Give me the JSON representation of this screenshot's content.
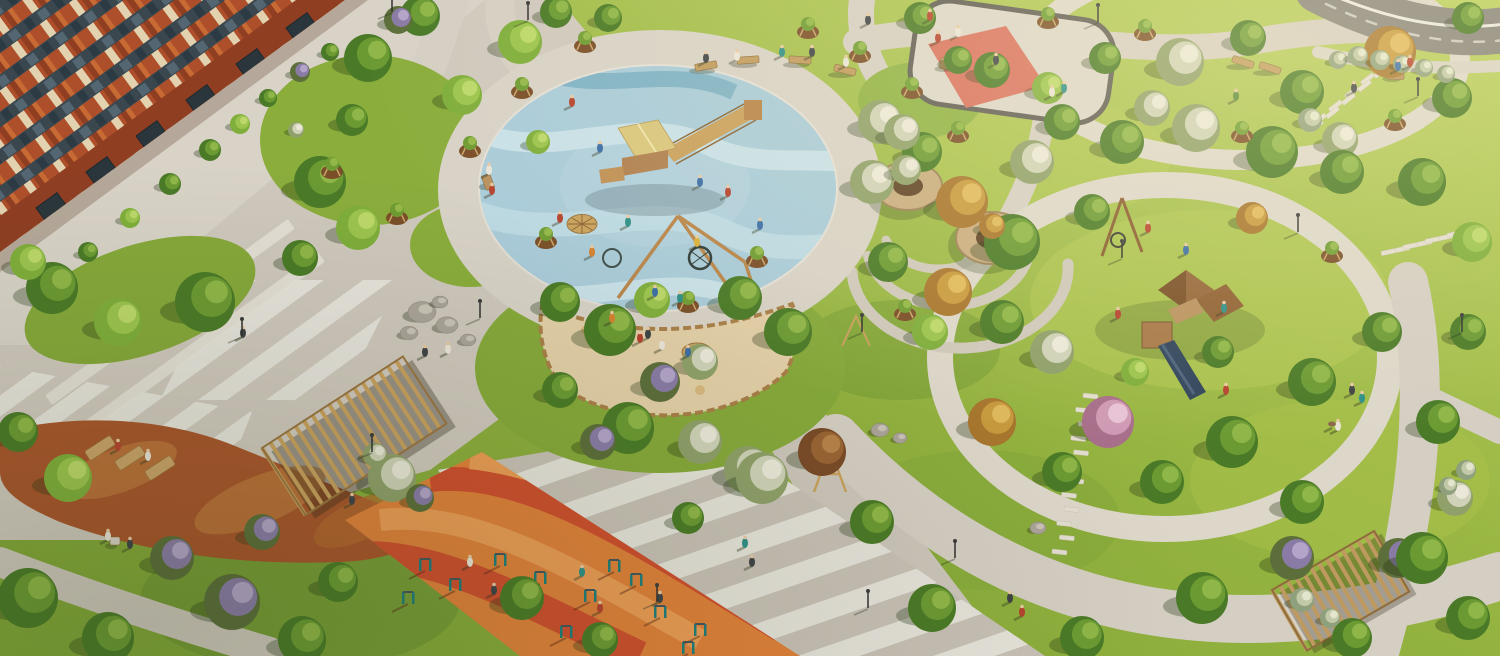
{
  "meta": {
    "description": "aerial 3D rendering of residential courtyard park with playgrounds, paths and trees",
    "width": 1500,
    "height": 656
  },
  "palette": {
    "grass_light": "#bcd05e",
    "grass_mid": "#93b23f",
    "grass_dark": "#7fa437",
    "paving": "#d2cbc0",
    "paving_light": "#e9e6de",
    "paving_shade": "#b9b2a7",
    "asphalt": "#87837c",
    "brick_orange": "#b4532c",
    "brick_dark": "#8f3e22",
    "cream_panel": "#e3d2b0",
    "window_glass": "#3a474f",
    "rubber_blue": "#a9cbd9",
    "rubber_blue_light": "#c8e0e8",
    "rubber_blue_deep": "#7fb2c6",
    "sand": "#e3cfa8",
    "log_border": "#a97e48",
    "sport_orange": "#e0813a",
    "sport_red": "#cf4e2e",
    "sport_salmon": "#ec9c55",
    "mulch_rust": "#a8552b",
    "mulch_light": "#c07a3e",
    "wood": "#b8925e",
    "wood_dark": "#8a6434",
    "wood_roof": "#8a5c30",
    "slide_navy": "#31455c",
    "equipment_teal": "#1f7d7a",
    "plaza_red": "#d9705f",
    "stone": "#e3ddcf"
  },
  "tree_colors": {
    "g": [
      "#4a7a27",
      "#6b9a33",
      "#8fb648"
    ],
    "gl": [
      "#7fae3b",
      "#9cc44e",
      "#bcd86a"
    ],
    "bw": [
      "#8fa06a",
      "#cfd2b8",
      "#ebe8d9"
    ],
    "bp": [
      "#a86f8a",
      "#cf9ab4",
      "#e7c3d6"
    ],
    "gold": [
      "#a8762e",
      "#c89a3e",
      "#e0b95c"
    ],
    "ar": [
      "#7a4a28",
      "#9a6434",
      "#b8824a"
    ],
    "lilac": [
      "#5c6e3a",
      "#8a7ba6",
      "#b3a4c9"
    ],
    "silver": [
      "#8fa07c",
      "#c2c9a8",
      "#e3e6cd"
    ]
  },
  "people_colors": {
    "red": "#b5422e",
    "blue": "#3c6da5",
    "teal": "#2e8f86",
    "orange": "#d4802f",
    "white": "#e9e4d8",
    "dark": "#3f4346",
    "yellow": "#d9b13b",
    "green": "#5a8a3c",
    "pink": "#c77a8a",
    "dog": "#8a6a4a"
  },
  "scene": {
    "areas": [
      "apartment-building",
      "central-splash-playground",
      "sandbox",
      "workout-ground",
      "table-tennis-plaza",
      "lawn-playground",
      "loop-paths",
      "pergolas",
      "autumn-mulch-garden"
    ]
  },
  "trees": [
    [
      368,
      58,
      24,
      "g"
    ],
    [
      420,
      16,
      20,
      "g"
    ],
    [
      462,
      95,
      20,
      "gl"
    ],
    [
      352,
      120,
      16,
      "g"
    ],
    [
      320,
      182,
      26,
      "g"
    ],
    [
      358,
      228,
      22,
      "gl"
    ],
    [
      300,
      258,
      18,
      "g"
    ],
    [
      52,
      288,
      26,
      "g"
    ],
    [
      118,
      322,
      24,
      "gl"
    ],
    [
      205,
      302,
      30,
      "g"
    ],
    [
      28,
      262,
      18,
      "gl"
    ],
    [
      520,
      42,
      22,
      "gl"
    ],
    [
      556,
      12,
      16,
      "g"
    ],
    [
      608,
      18,
      14,
      "g"
    ],
    [
      880,
      122,
      22,
      "bw"
    ],
    [
      920,
      18,
      16,
      "g"
    ],
    [
      560,
      302,
      20,
      "g"
    ],
    [
      610,
      330,
      26,
      "g"
    ],
    [
      652,
      300,
      18,
      "gl"
    ],
    [
      740,
      298,
      22,
      "g"
    ],
    [
      788,
      332,
      24,
      "g"
    ],
    [
      628,
      428,
      26,
      "g"
    ],
    [
      560,
      390,
      18,
      "g"
    ],
    [
      700,
      442,
      22,
      "bw"
    ],
    [
      748,
      470,
      24,
      "bw"
    ],
    [
      660,
      382,
      20,
      "lilac"
    ],
    [
      700,
      362,
      18,
      "bw"
    ],
    [
      872,
      182,
      22,
      "bw"
    ],
    [
      922,
      152,
      20,
      "g"
    ],
    [
      962,
      202,
      26,
      "gold"
    ],
    [
      1012,
      242,
      28,
      "g"
    ],
    [
      948,
      292,
      24,
      "gold"
    ],
    [
      1002,
      322,
      22,
      "g"
    ],
    [
      888,
      262,
      20,
      "g"
    ],
    [
      930,
      332,
      18,
      "gl"
    ],
    [
      1032,
      162,
      22,
      "bw"
    ],
    [
      1062,
      122,
      18,
      "g"
    ],
    [
      992,
      70,
      18,
      "g"
    ],
    [
      1048,
      88,
      16,
      "gl"
    ],
    [
      902,
      132,
      18,
      "bw"
    ],
    [
      958,
      60,
      14,
      "g"
    ],
    [
      1105,
      58,
      16,
      "g"
    ],
    [
      1180,
      62,
      24,
      "bw"
    ],
    [
      1248,
      38,
      18,
      "g"
    ],
    [
      1302,
      92,
      22,
      "g"
    ],
    [
      1390,
      52,
      26,
      "gold"
    ],
    [
      1452,
      98,
      20,
      "g"
    ],
    [
      1468,
      18,
      16,
      "g"
    ],
    [
      1340,
      140,
      18,
      "bw"
    ],
    [
      1122,
      142,
      22,
      "g"
    ],
    [
      1196,
      128,
      24,
      "bw"
    ],
    [
      1152,
      108,
      18,
      "bw"
    ],
    [
      1272,
      152,
      26,
      "g"
    ],
    [
      1342,
      172,
      22,
      "g"
    ],
    [
      1422,
      182,
      24,
      "g"
    ],
    [
      1472,
      242,
      20,
      "gl"
    ],
    [
      1092,
      212,
      18,
      "g"
    ],
    [
      1252,
      218,
      16,
      "gold"
    ],
    [
      1108,
      422,
      26,
      "bp"
    ],
    [
      1052,
      352,
      22,
      "bw"
    ],
    [
      992,
      422,
      24,
      "gold"
    ],
    [
      1062,
      472,
      20,
      "g"
    ],
    [
      1162,
      482,
      22,
      "g"
    ],
    [
      1232,
      442,
      26,
      "g"
    ],
    [
      1312,
      382,
      24,
      "g"
    ],
    [
      1382,
      332,
      20,
      "g"
    ],
    [
      1302,
      502,
      22,
      "g"
    ],
    [
      1398,
      558,
      20,
      "lilac"
    ],
    [
      1438,
      422,
      22,
      "g"
    ],
    [
      1468,
      332,
      18,
      "g"
    ],
    [
      1218,
      352,
      16,
      "g"
    ],
    [
      1135,
      372,
      14,
      "gl"
    ],
    [
      28,
      598,
      30,
      "g"
    ],
    [
      108,
      638,
      26,
      "g"
    ],
    [
      232,
      602,
      28,
      "lilac"
    ],
    [
      302,
      640,
      24,
      "g"
    ],
    [
      172,
      558,
      22,
      "lilac"
    ],
    [
      68,
      478,
      24,
      "gl"
    ],
    [
      18,
      432,
      20,
      "g"
    ],
    [
      262,
      532,
      18,
      "lilac"
    ],
    [
      338,
      582,
      20,
      "g"
    ],
    [
      392,
      478,
      24,
      "bw"
    ],
    [
      522,
      598,
      22,
      "g"
    ],
    [
      600,
      640,
      18,
      "g"
    ],
    [
      762,
      478,
      26,
      "bw"
    ],
    [
      822,
      452,
      24,
      "ar"
    ],
    [
      872,
      522,
      22,
      "g"
    ],
    [
      932,
      608,
      24,
      "g"
    ],
    [
      1082,
      638,
      22,
      "g"
    ],
    [
      598,
      442,
      18,
      "lilac"
    ],
    [
      688,
      518,
      16,
      "g"
    ],
    [
      1202,
      598,
      26,
      "g"
    ],
    [
      1292,
      558,
      22,
      "lilac"
    ],
    [
      1422,
      558,
      26,
      "g"
    ],
    [
      1468,
      618,
      22,
      "g"
    ],
    [
      1352,
      638,
      20,
      "g"
    ],
    [
      1455,
      498,
      18,
      "bw"
    ],
    [
      210,
      150,
      11,
      "g"
    ],
    [
      240,
      124,
      10,
      "gl"
    ],
    [
      170,
      184,
      11,
      "g"
    ],
    [
      130,
      218,
      10,
      "gl"
    ],
    [
      88,
      252,
      10,
      "g"
    ],
    [
      268,
      98,
      9,
      "g"
    ],
    [
      300,
      72,
      10,
      "lilac"
    ],
    [
      330,
      52,
      9,
      "g"
    ],
    [
      296,
      130,
      8,
      "bw"
    ],
    [
      398,
      20,
      14,
      "lilac"
    ],
    [
      1338,
      60,
      9,
      "silver"
    ],
    [
      1358,
      56,
      10,
      "silver"
    ],
    [
      1380,
      60,
      10,
      "silver"
    ],
    [
      1402,
      64,
      9,
      "silver"
    ],
    [
      1424,
      68,
      9,
      "silver"
    ],
    [
      1446,
      74,
      9,
      "silver"
    ],
    [
      1310,
      120,
      12,
      "silver"
    ],
    [
      1466,
      470,
      10,
      "silver"
    ],
    [
      1448,
      486,
      9,
      "silver"
    ],
    [
      1302,
      600,
      12,
      "silver"
    ],
    [
      1330,
      618,
      10,
      "silver"
    ],
    [
      906,
      170,
      15,
      "bw"
    ],
    [
      992,
      226,
      13,
      "gold"
    ],
    [
      420,
      498,
      14,
      "lilac"
    ],
    [
      375,
      455,
      12,
      "bw"
    ],
    [
      538,
      142,
      12,
      "gl"
    ]
  ],
  "saplings": [
    [
      585,
      42
    ],
    [
      522,
      88
    ],
    [
      470,
      147
    ],
    [
      332,
      168
    ],
    [
      397,
      214
    ],
    [
      546,
      238
    ],
    [
      860,
      52
    ],
    [
      912,
      88
    ],
    [
      958,
      132
    ],
    [
      1145,
      30
    ],
    [
      1242,
      132
    ],
    [
      1332,
      252
    ],
    [
      688,
      302
    ],
    [
      757,
      257
    ],
    [
      808,
      28
    ],
    [
      1048,
      18
    ],
    [
      1395,
      120
    ],
    [
      905,
      310
    ]
  ],
  "people": [
    [
      572,
      102,
      "red"
    ],
    [
      600,
      148,
      "blue"
    ],
    [
      628,
      222,
      "teal"
    ],
    [
      560,
      218,
      "red"
    ],
    [
      592,
      252,
      "orange"
    ],
    [
      655,
      292,
      "blue"
    ],
    [
      680,
      298,
      "teal"
    ],
    [
      700,
      182,
      "blue"
    ],
    [
      728,
      192,
      "red"
    ],
    [
      612,
      318,
      "orange"
    ],
    [
      648,
      334,
      "dark"
    ],
    [
      760,
      225,
      "blue"
    ],
    [
      697,
      242,
      "yellow"
    ],
    [
      706,
      58,
      "dark"
    ],
    [
      737,
      56,
      "white"
    ],
    [
      782,
      52,
      "teal"
    ],
    [
      812,
      52,
      "dark"
    ],
    [
      846,
      62,
      "white"
    ],
    [
      489,
      170,
      "white"
    ],
    [
      492,
      190,
      "red"
    ],
    [
      243,
      333,
      "dark"
    ],
    [
      425,
      352,
      "dark"
    ],
    [
      448,
      349,
      "white"
    ],
    [
      640,
      338,
      "red"
    ],
    [
      662,
      345,
      "white"
    ],
    [
      688,
      352,
      "blue"
    ],
    [
      745,
      543,
      "teal"
    ],
    [
      752,
      562,
      "dark"
    ],
    [
      660,
      598,
      "dark"
    ],
    [
      1010,
      598,
      "dark"
    ],
    [
      1022,
      612,
      "red"
    ],
    [
      1052,
      92,
      "white"
    ],
    [
      1064,
      88,
      "teal"
    ],
    [
      938,
      38,
      "red"
    ],
    [
      958,
      32,
      "white"
    ],
    [
      996,
      60,
      "dark"
    ],
    [
      1352,
      390,
      "dark"
    ],
    [
      1362,
      398,
      "teal"
    ],
    [
      1338,
      426,
      "white"
    ],
    [
      1332,
      424,
      "dog"
    ],
    [
      1148,
      228,
      "red"
    ],
    [
      1186,
      250,
      "blue"
    ],
    [
      1224,
      308,
      "teal"
    ],
    [
      1118,
      314,
      "red"
    ],
    [
      1226,
      390,
      "red"
    ],
    [
      1236,
      96,
      "green"
    ],
    [
      118,
      446,
      "red"
    ],
    [
      148,
      456,
      "white"
    ],
    [
      108,
      536,
      "white"
    ],
    [
      130,
      544,
      "dark"
    ],
    [
      1398,
      66,
      "blue"
    ],
    [
      1410,
      62,
      "red"
    ],
    [
      1354,
      88,
      "dark"
    ],
    [
      470,
      562,
      "white"
    ],
    [
      494,
      590,
      "dark"
    ],
    [
      600,
      608,
      "red"
    ],
    [
      582,
      572,
      "teal"
    ],
    [
      930,
      16,
      "red"
    ],
    [
      868,
      20,
      "dark"
    ],
    [
      352,
      500,
      "dark"
    ]
  ],
  "lamps": [
    [
      392,
      12
    ],
    [
      480,
      318
    ],
    [
      657,
      602
    ],
    [
      862,
      332
    ],
    [
      955,
      558
    ],
    [
      1122,
      258
    ],
    [
      1418,
      96
    ],
    [
      1298,
      232
    ],
    [
      242,
      336
    ],
    [
      1462,
      332
    ],
    [
      372,
      452
    ],
    [
      528,
      20
    ],
    [
      1098,
      22
    ],
    [
      868,
      608
    ]
  ],
  "equipment": [
    [
      425,
      565
    ],
    [
      455,
      585
    ],
    [
      408,
      598
    ],
    [
      500,
      560
    ],
    [
      540,
      578
    ],
    [
      590,
      596
    ],
    [
      614,
      566
    ],
    [
      660,
      612
    ],
    [
      700,
      630
    ],
    [
      566,
      632
    ],
    [
      636,
      580
    ],
    [
      688,
      648
    ]
  ],
  "rocks": [
    [
      422,
      312,
      14
    ],
    [
      447,
      325,
      11
    ],
    [
      409,
      333,
      9
    ],
    [
      468,
      340,
      8
    ],
    [
      440,
      302,
      8
    ],
    [
      620,
      414,
      7
    ],
    [
      880,
      430,
      9
    ],
    [
      900,
      438,
      7
    ],
    [
      1038,
      528,
      8
    ],
    [
      1452,
      500,
      7
    ]
  ],
  "stones": [
    [
      1062,
      552,
      1088,
      396,
      12,
      6,
      5
    ],
    [
      1402,
      52,
      1314,
      126,
      12,
      -38,
      5
    ],
    [
      1390,
      252,
      1456,
      234,
      7,
      -12,
      3
    ]
  ],
  "benches": [
    [
      706,
      66,
      -10,
      "bench"
    ],
    [
      748,
      60,
      -4,
      "bench"
    ],
    [
      800,
      60,
      4,
      "bench"
    ],
    [
      845,
      70,
      14,
      "bench"
    ],
    [
      1243,
      62,
      18,
      "bench"
    ],
    [
      1270,
      68,
      18,
      "bench"
    ],
    [
      488,
      182,
      -20,
      "tall"
    ],
    [
      1396,
      74,
      0,
      "table"
    ],
    [
      115,
      541,
      0,
      "table-s"
    ],
    [
      948,
      64,
      8,
      "table"
    ]
  ],
  "loungers": [
    [
      100,
      448
    ],
    [
      130,
      458
    ],
    [
      160,
      468
    ]
  ],
  "storefronts": [
    [
      36,
      208
    ],
    [
      86,
      172
    ],
    [
      136,
      136
    ],
    [
      186,
      100
    ],
    [
      236,
      64
    ],
    [
      286,
      28
    ]
  ]
}
